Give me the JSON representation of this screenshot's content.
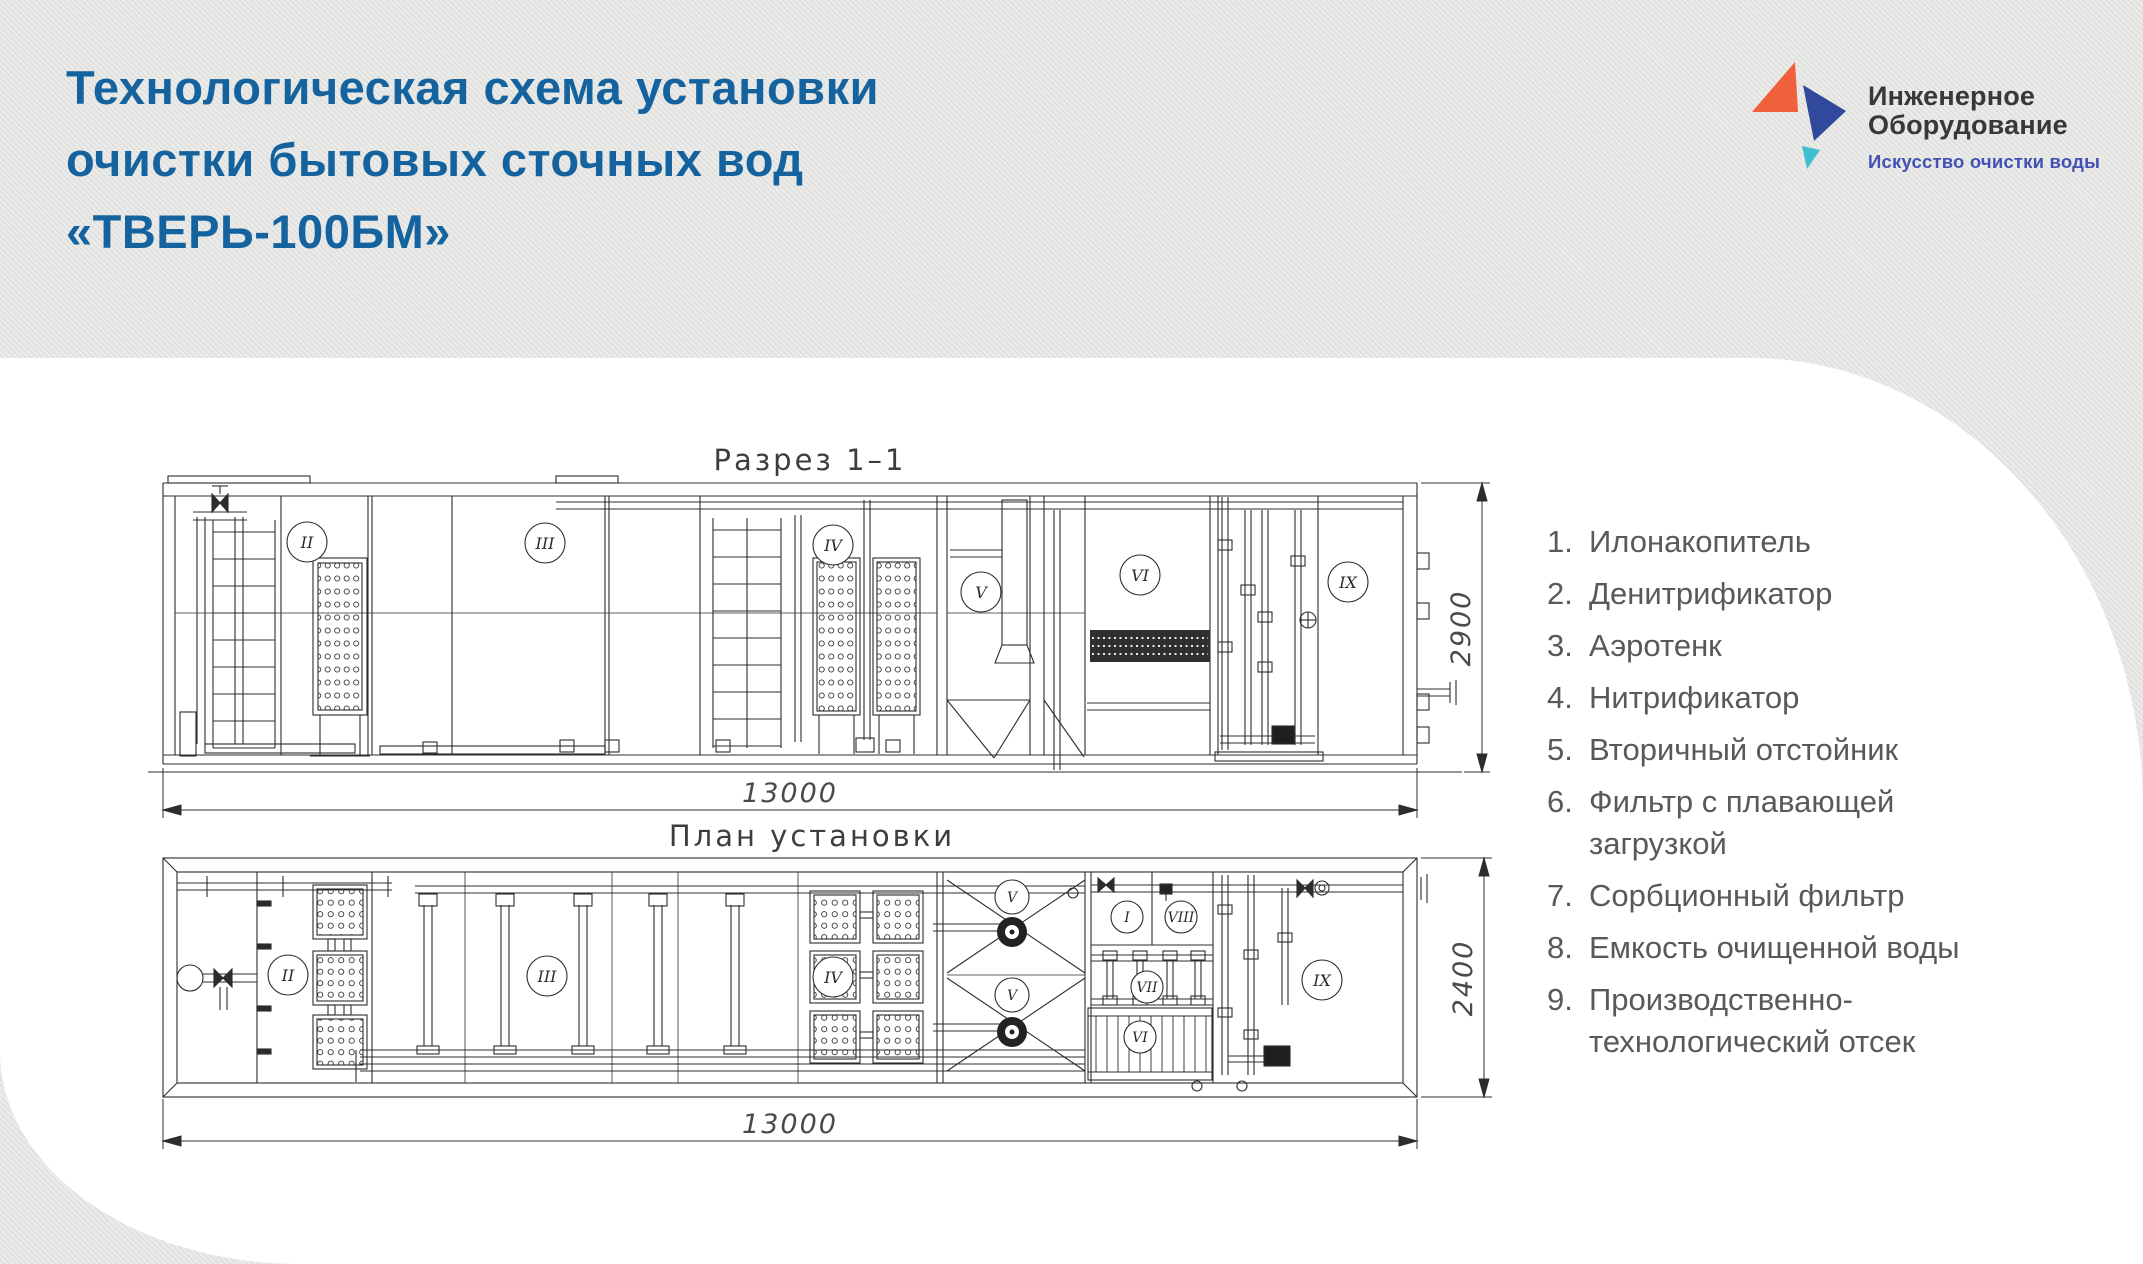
{
  "title": {
    "line1": "Технологическая схема установки",
    "line2": "очистки бытовых сточных вод",
    "line3": "«ТВЕРЬ-100БМ»"
  },
  "logo": {
    "name_line1": "Инженерное",
    "name_line2": "Оборудование",
    "tagline": "Искусство очистки воды",
    "colors": {
      "orange": "#f0603a",
      "blue": "#30499c",
      "teal": "#3fbfd2",
      "tagline_blue": "#4251b5",
      "text": "#38383a"
    }
  },
  "drawings": {
    "section": {
      "title": "Разрез  1–1",
      "width_label": "13000",
      "height_label": "2900",
      "labels": [
        "II",
        "III",
        "IV",
        "V",
        "VI",
        "IX"
      ]
    },
    "plan": {
      "title": "План  установки",
      "width_label": "13000",
      "height_label": "2400",
      "labels": [
        "II",
        "III",
        "IV",
        "V",
        "V",
        "I",
        "VIII",
        "VII",
        "VI",
        "IX"
      ]
    }
  },
  "legend": {
    "items": [
      {
        "num": "1.",
        "text": "Илонакопитель"
      },
      {
        "num": "2.",
        "text": "Денитрификатор"
      },
      {
        "num": "3.",
        "text": "Аэротенк"
      },
      {
        "num": "4.",
        "text": "Нитрификатор"
      },
      {
        "num": "5.",
        "text": "Вторичный отстойник"
      },
      {
        "num": "6.",
        "text": "Фильтр с плавающей загрузкой"
      },
      {
        "num": "7.",
        "text": "Сорбционный фильтр"
      },
      {
        "num": "8.",
        "text": "Емкость очищенной воды"
      },
      {
        "num": "9.",
        "text": "Производственно-технологический отсек"
      }
    ]
  },
  "colors": {
    "title_blue": "#15639e",
    "background": "#e3e3e1",
    "panel": "#ffffff",
    "line": "#2c2c2c",
    "legend_text": "#58595b"
  }
}
